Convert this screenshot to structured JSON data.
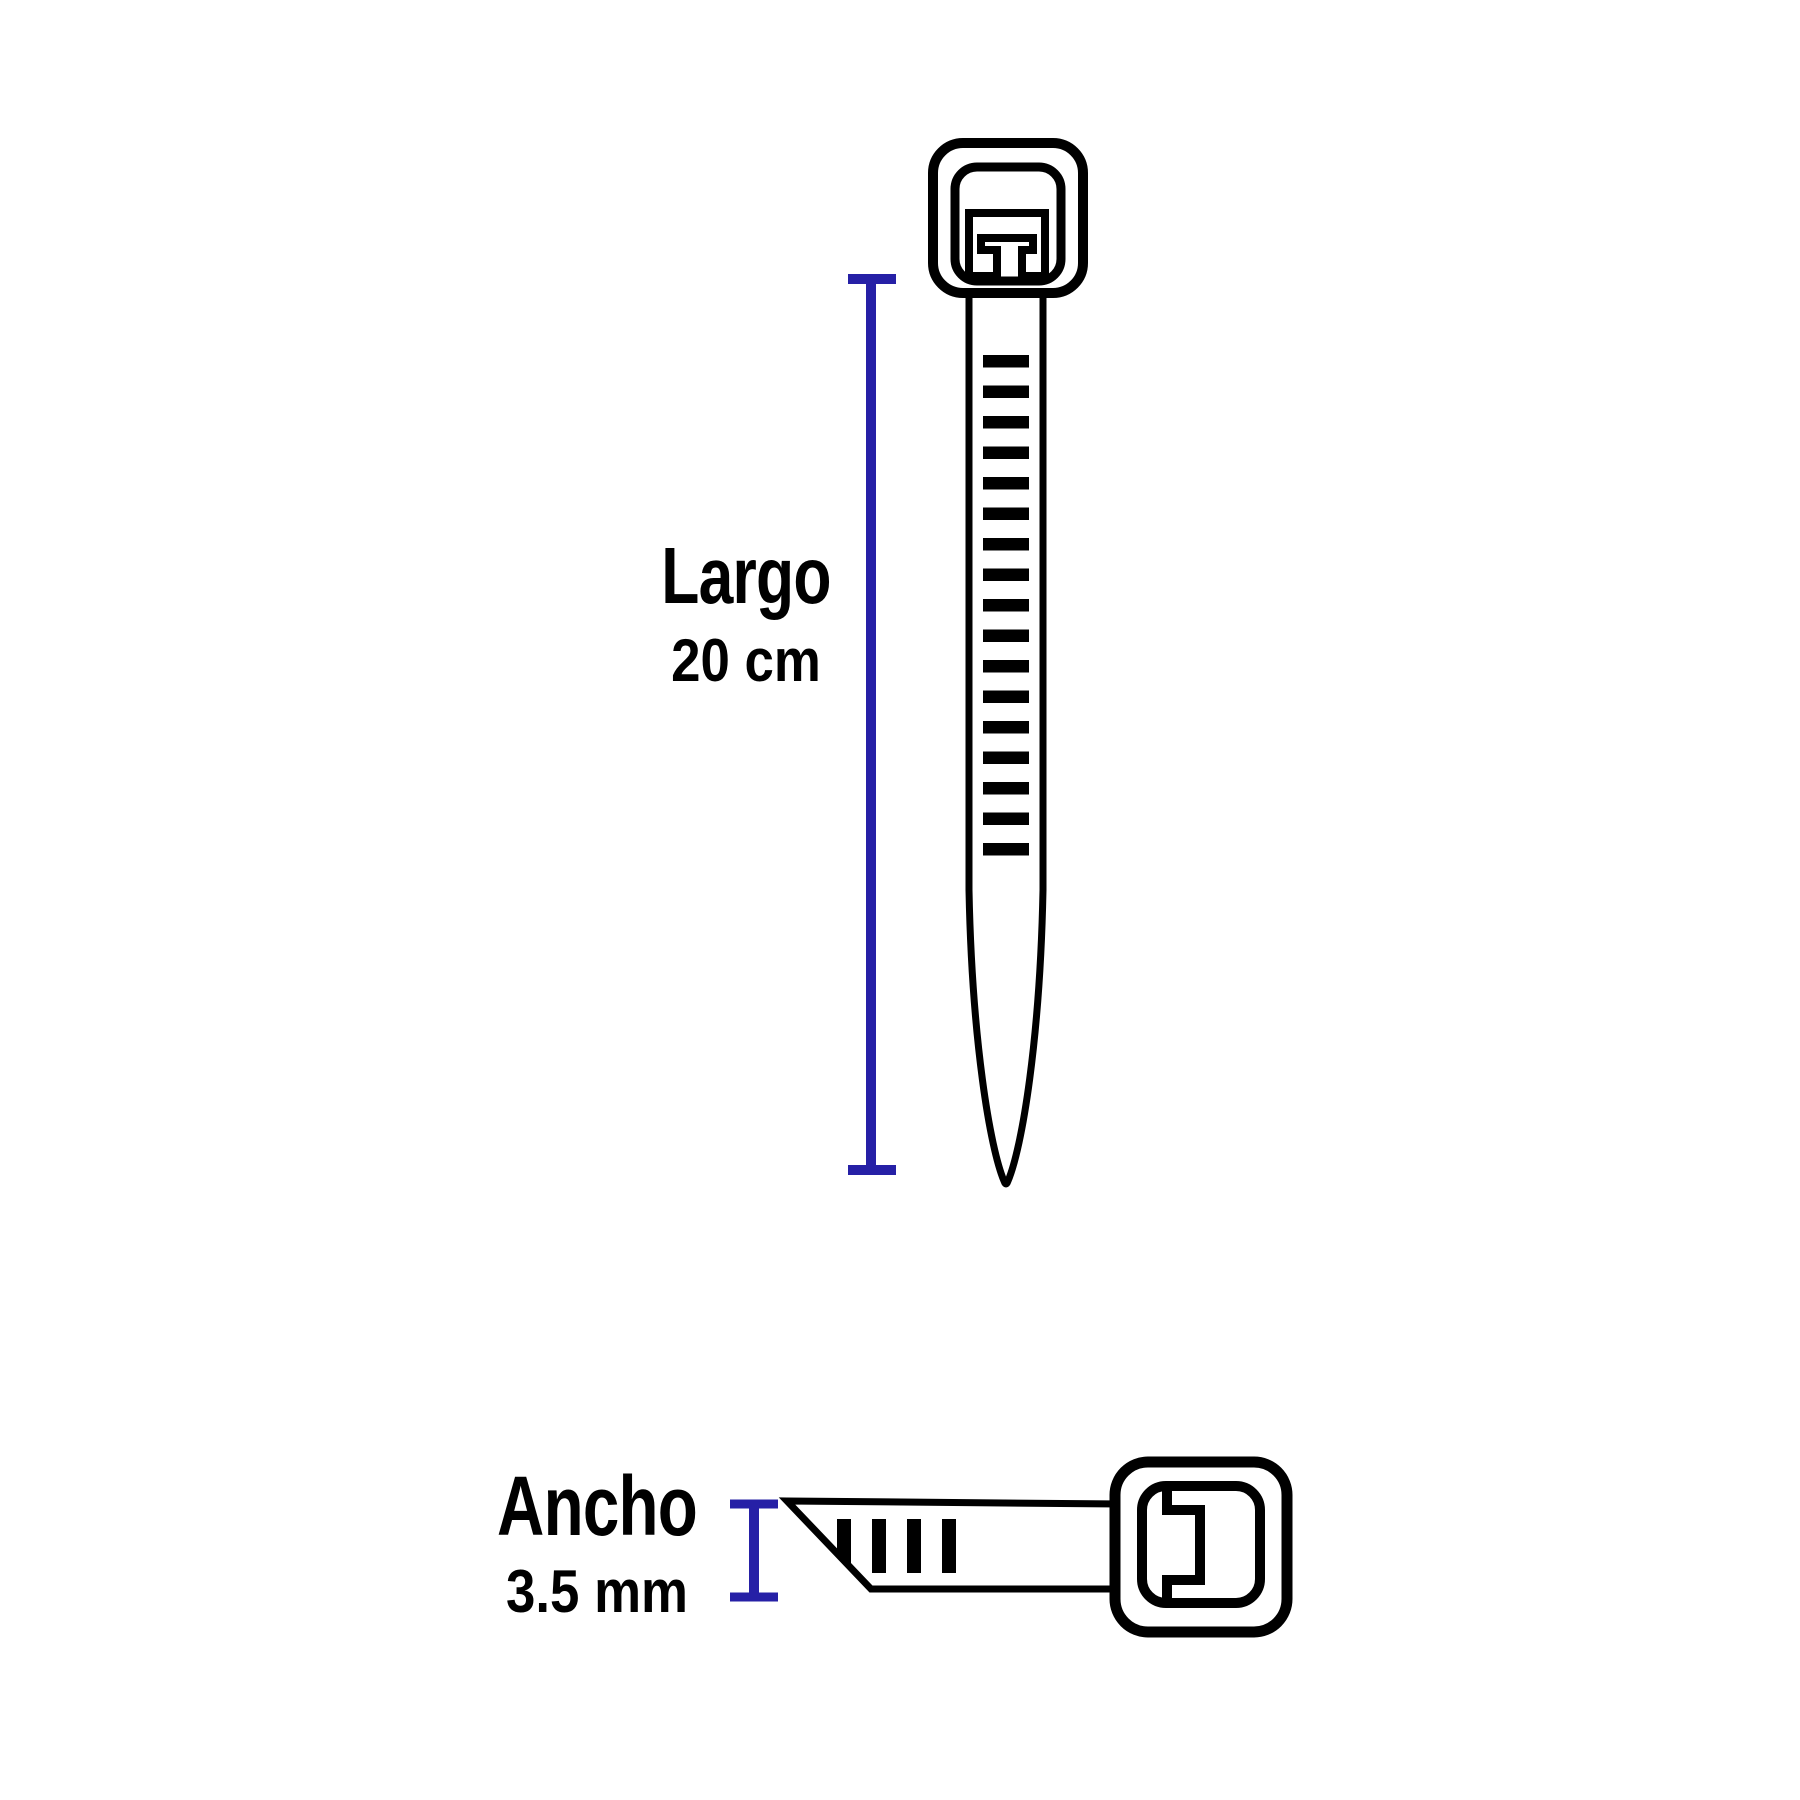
{
  "page": {
    "background": "#ffffff",
    "description": "Cable tie dimensions diagram"
  },
  "colors": {
    "outline": "#000000",
    "dimension_line": "#2620A6",
    "text": "#000000"
  },
  "dimensions": {
    "length": {
      "label": "Largo",
      "value": "20 cm"
    },
    "width": {
      "label": "Ancho",
      "value": "3.5 mm"
    }
  },
  "diagram": {
    "vertical_tie": {
      "view": "full-length cable tie, head up, tapered tail down",
      "teeth_count": 17
    },
    "horizontal_tie": {
      "view": "cable tie width view, head right, tapered tail left",
      "teeth_count": 4
    }
  }
}
